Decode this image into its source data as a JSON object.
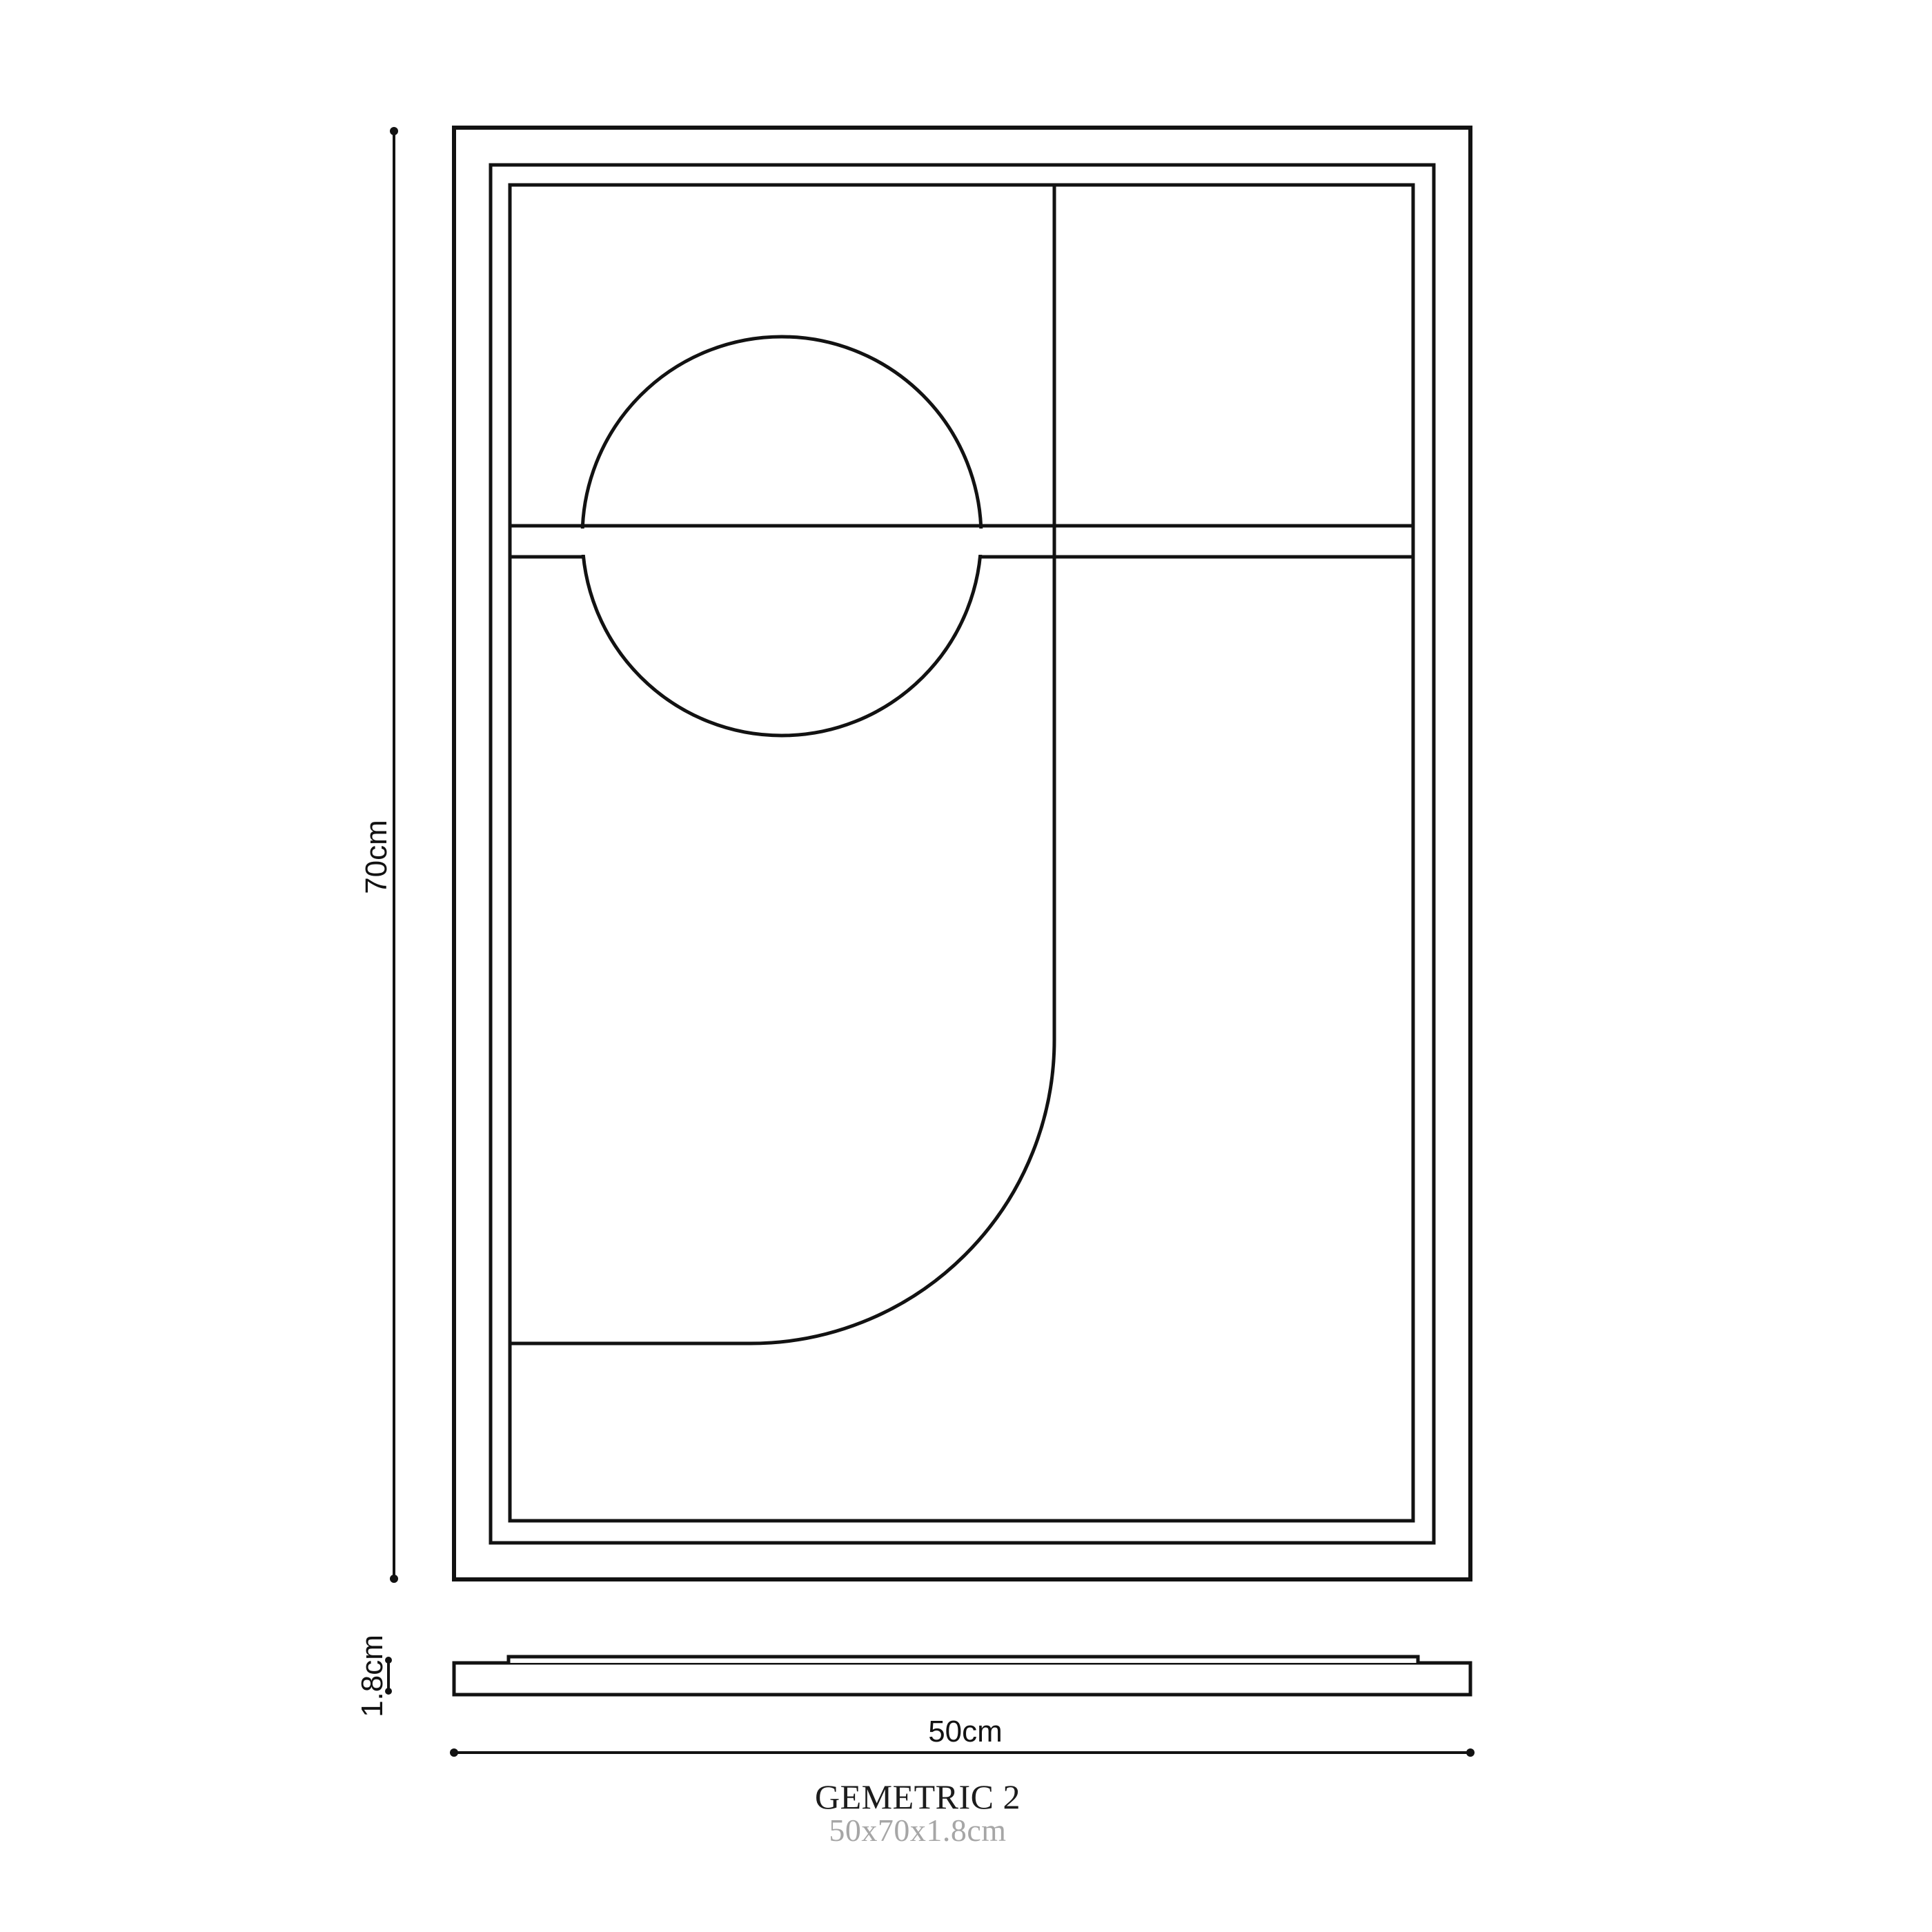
{
  "page": {
    "background": "#ffffff"
  },
  "drawing": {
    "line_color": "#121212",
    "labels": {
      "height": "70cm",
      "thickness": "1.8cm",
      "width": "50cm"
    },
    "title": {
      "name": "GEMETRIC 2",
      "dimensions": "50x70x1.8cm",
      "title_color": "#1c1c1c",
      "subtitle_color": "#a6a6a6"
    }
  }
}
